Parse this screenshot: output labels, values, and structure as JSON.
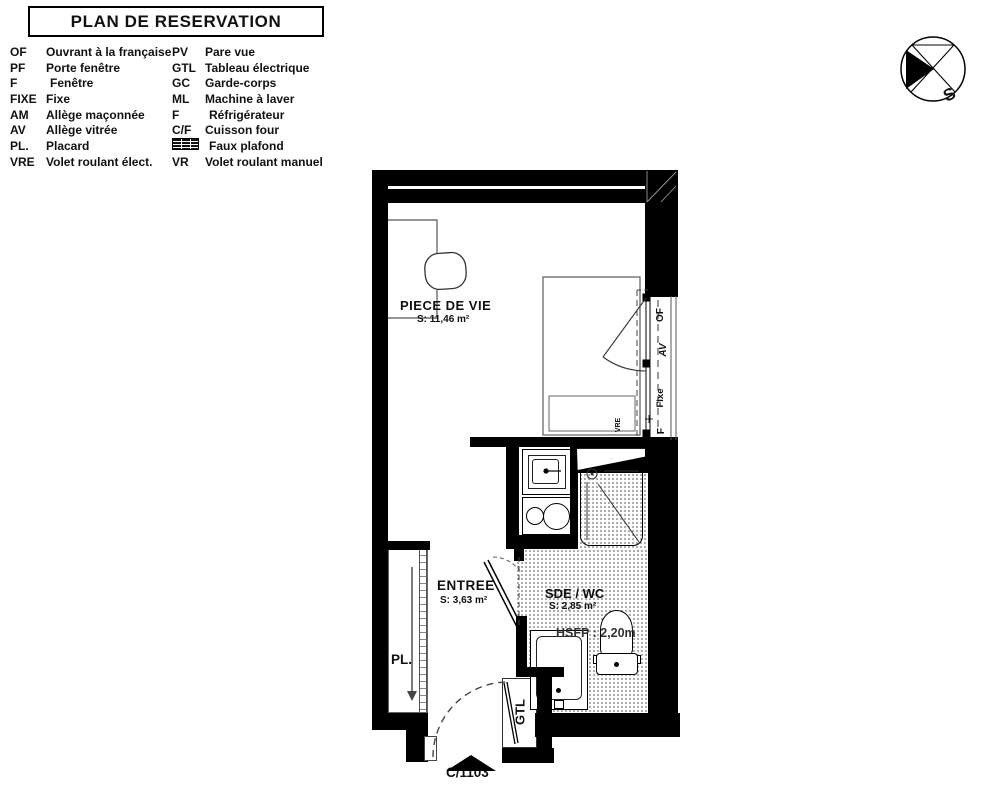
{
  "title": "PLAN DE RESERVATION",
  "legend": {
    "col1": [
      {
        "abbr": "OF",
        "label": "Ouvrant à la française"
      },
      {
        "abbr": "PF",
        "label": "Porte fenêtre"
      },
      {
        "abbr": "F",
        "label": "Fenêtre"
      },
      {
        "abbr": "FIXE",
        "label": "Fixe"
      },
      {
        "abbr": "AM",
        "label": "Allège maçonnée"
      },
      {
        "abbr": "AV",
        "label": "Allège vitrée"
      },
      {
        "abbr": "PL.",
        "label": "Placard"
      },
      {
        "abbr": "VRE",
        "label": "Volet roulant élect."
      }
    ],
    "col2": [
      {
        "abbr": "PV",
        "label": "Pare vue"
      },
      {
        "abbr": "GTL",
        "label": "Tableau électrique"
      },
      {
        "abbr": "GC",
        "label": "Garde-corps"
      },
      {
        "abbr": "ML",
        "label": "Machine à laver"
      },
      {
        "abbr": "F",
        "label": "Réfrigérateur"
      },
      {
        "abbr": "C/F",
        "label": "Cuisson four"
      },
      {
        "abbr": "",
        "label": "Faux plafond"
      },
      {
        "abbr": "VR",
        "label": "Volet roulant manuel"
      }
    ]
  },
  "compass": {
    "label": "S"
  },
  "plan": {
    "rooms": {
      "living": {
        "name": "PIECE DE VIE",
        "area": "S: 11,46 m²"
      },
      "entry": {
        "name": "ENTREE",
        "area": "S: 3,63 m²"
      },
      "bath": {
        "name": "SDE / WC",
        "area": "S: 2,85 m²"
      }
    },
    "labels": {
      "ceiling": "HSFP : 2,20m",
      "closet": "PL.",
      "gtl": "GTL",
      "vre": "VRE",
      "unit": "C/1103",
      "window": {
        "of": "OF",
        "av": "AV",
        "fixe": "Fixe",
        "f": "F"
      }
    }
  },
  "colors": {
    "wall": "#000000",
    "line": "#555555",
    "text": "#111111"
  }
}
